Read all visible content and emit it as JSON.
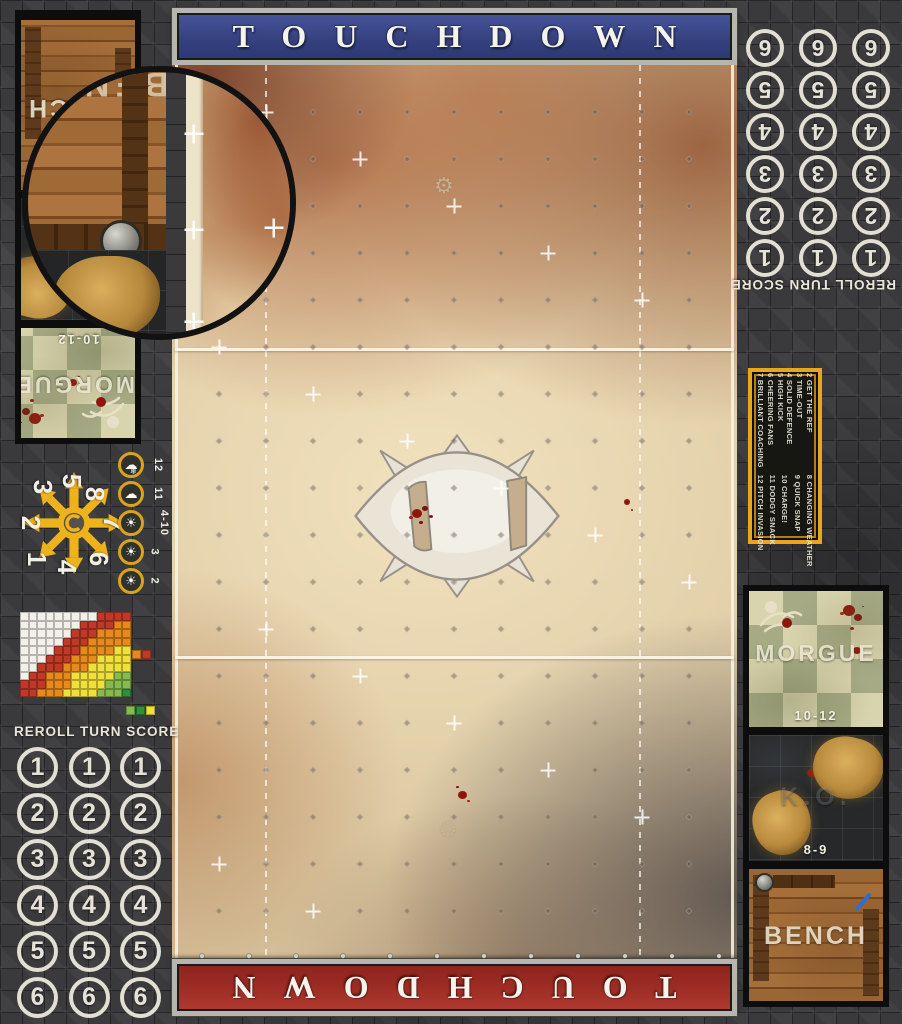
{
  "banners": {
    "top_label": "TOUCHDOWN",
    "bottom_label": "TOUCHDOWN",
    "top_color": "#3c4a8d",
    "bottom_color": "#9e2b24"
  },
  "turn_track": {
    "header": "REROLL TURN SCORE",
    "numbers": [
      "1",
      "2",
      "3",
      "4",
      "5",
      "6"
    ],
    "columns_per_number": 3
  },
  "scatter_template": {
    "numbers": {
      "n1": "1",
      "n2": "2",
      "n3": "3",
      "n4": "4",
      "n5": "5",
      "n6": "6",
      "n7": "7",
      "n8": "8"
    }
  },
  "weather_track": {
    "rows": [
      {
        "label": "12",
        "icon": "snow-cloud"
      },
      {
        "label": "11",
        "icon": "rain-cloud"
      },
      {
        "label": "4-10",
        "icon": "sun"
      },
      {
        "label": "3",
        "icon": "sun"
      },
      {
        "label": "2",
        "icon": "sun"
      }
    ]
  },
  "range_chart": {
    "type": "heatmap",
    "rows": [
      "WWWWWWWWWRRRR",
      "WWWWWWWRRRROO",
      "WWWWWWRRROOOO",
      "WWWWWRRROOOOO",
      "WWWWRRROOOOYY",
      "WWWRRROOOYYYY",
      "WWRRROOOYYYYY",
      "WRROOOYYYYYGG",
      "RRROOOYYYYGGG",
      "RROOOYYYYGGGD"
    ],
    "legend_mid": [
      "O",
      "R"
    ],
    "legend_bottom": [
      "G",
      "D",
      "Y"
    ],
    "colors": {
      "W": "#f2f0e9",
      "R": "#c03927",
      "O": "#e8891d",
      "Y": "#f1e03b",
      "G": "#85bb4d",
      "D": "#2f8f3c"
    }
  },
  "kickoff_table": {
    "column1": [
      "2 GET THE REF",
      "3 TIME-OUT",
      "4 SOLID DEFENCE",
      "5 HIGH KICK",
      "6 CHEERING FANS",
      "7 BRILLIANT COACHING"
    ],
    "column2": [
      "8 CHANGING WEATHER",
      "9 QUICK SNAP",
      "10 CHARGE!",
      "11 DODGY SNACK",
      "12 PITCH INVASION"
    ]
  },
  "dugouts": {
    "morgue_label": "MORGUE",
    "morgue_range": "10-12",
    "ko_label": "K.O.",
    "ko_range": "8-9",
    "bench_label": "BENCH"
  },
  "pitch_grid": {
    "cols": 12,
    "rows": 19,
    "cell_px": 47
  },
  "theme": {
    "accent_yellow": "#eaa71c",
    "stone_grey": "#3a3a3c",
    "pitch_sand": "#dcc8a2",
    "morgue_green": "#a6ab85",
    "wood_brown": "#9a6634"
  }
}
